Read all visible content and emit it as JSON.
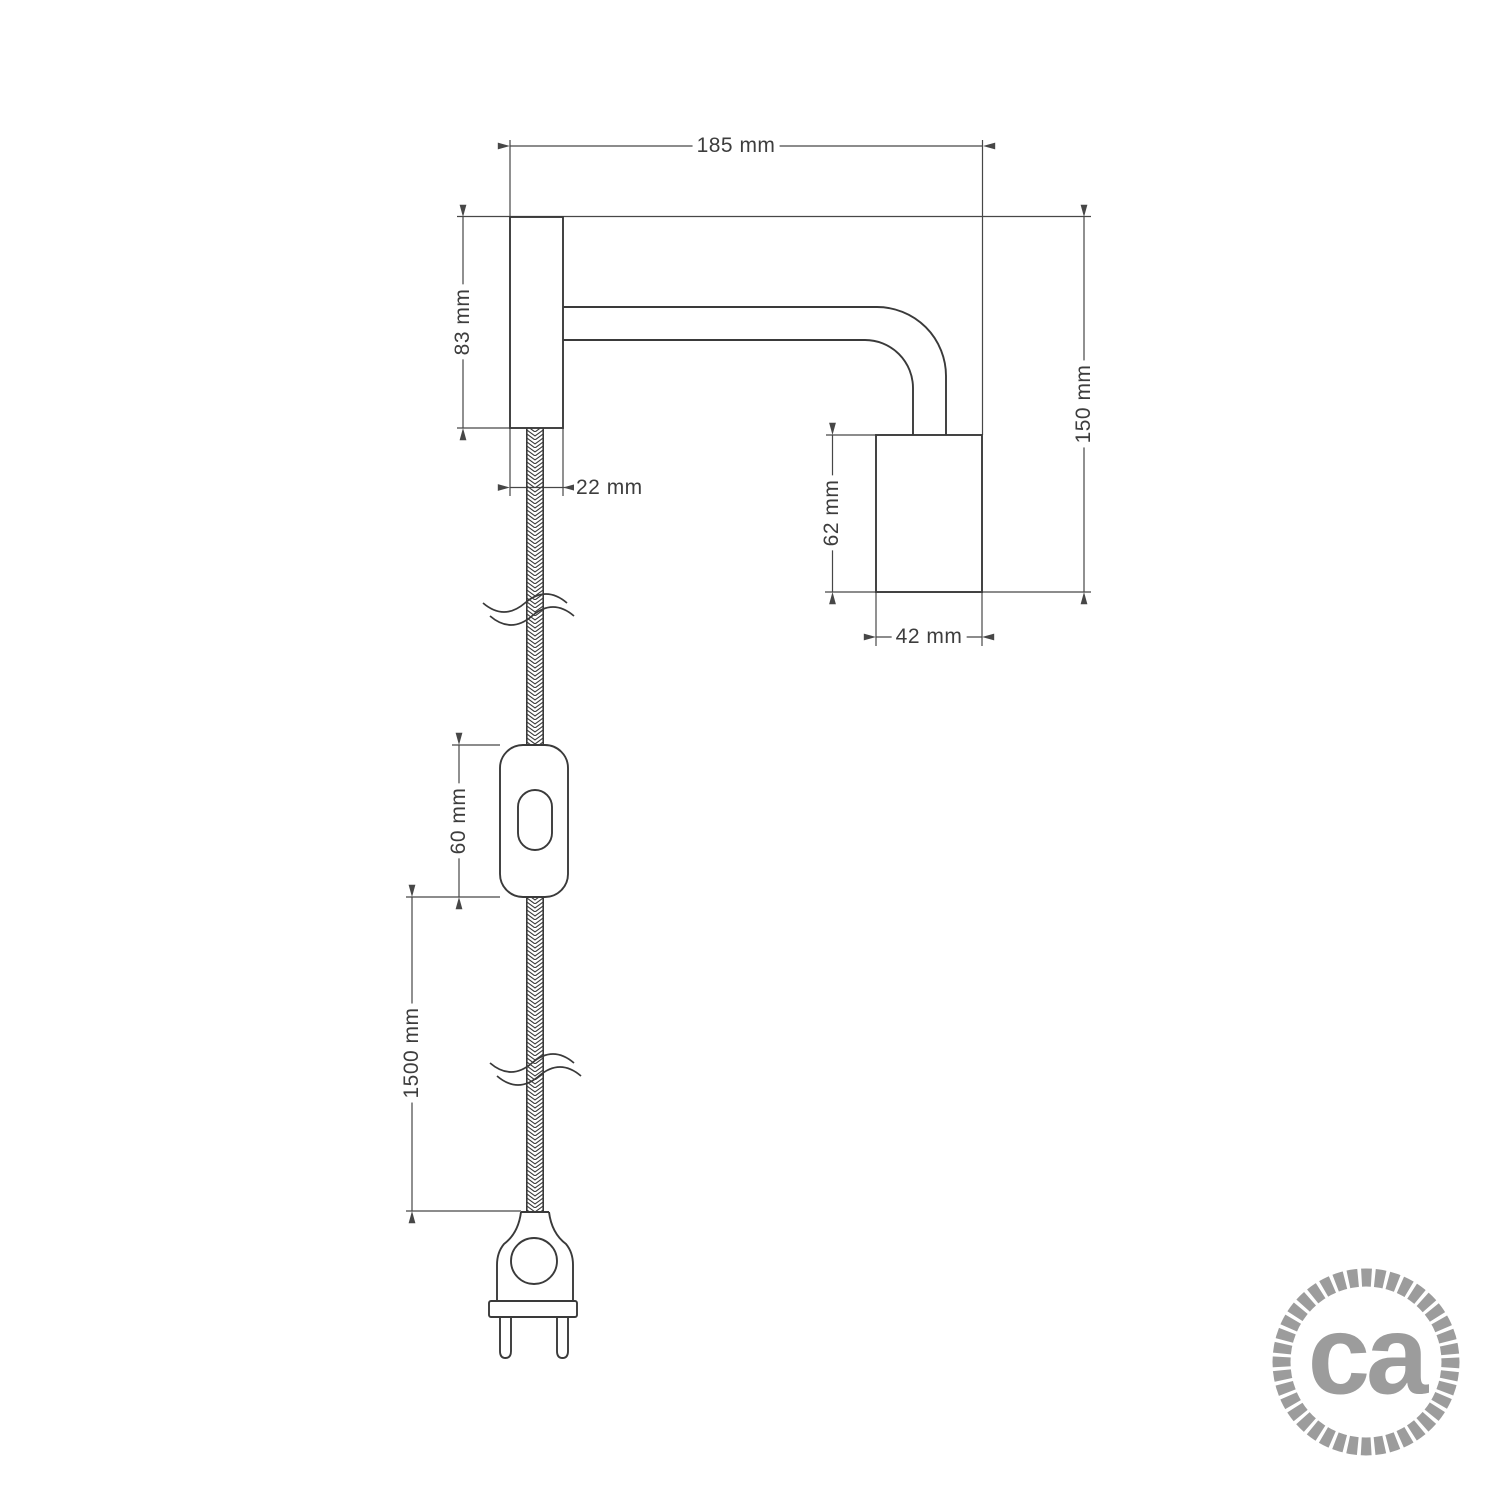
{
  "drawing": {
    "title": "wall lamp dimensional drawing",
    "dims": {
      "total_width": "185 mm",
      "bracket_height": "83 mm",
      "bracket_width": "22 mm",
      "total_height": "150 mm",
      "socket_height": "62 mm",
      "socket_width": "42 mm",
      "switch_length": "60 mm",
      "cable_length": "1500 mm"
    }
  },
  "logo": {
    "text": "ca"
  },
  "colors": {
    "outline": "#3a3a3a",
    "dimension": "#474747",
    "logo_gray": "#9c9c9c",
    "background": "#ffffff"
  }
}
